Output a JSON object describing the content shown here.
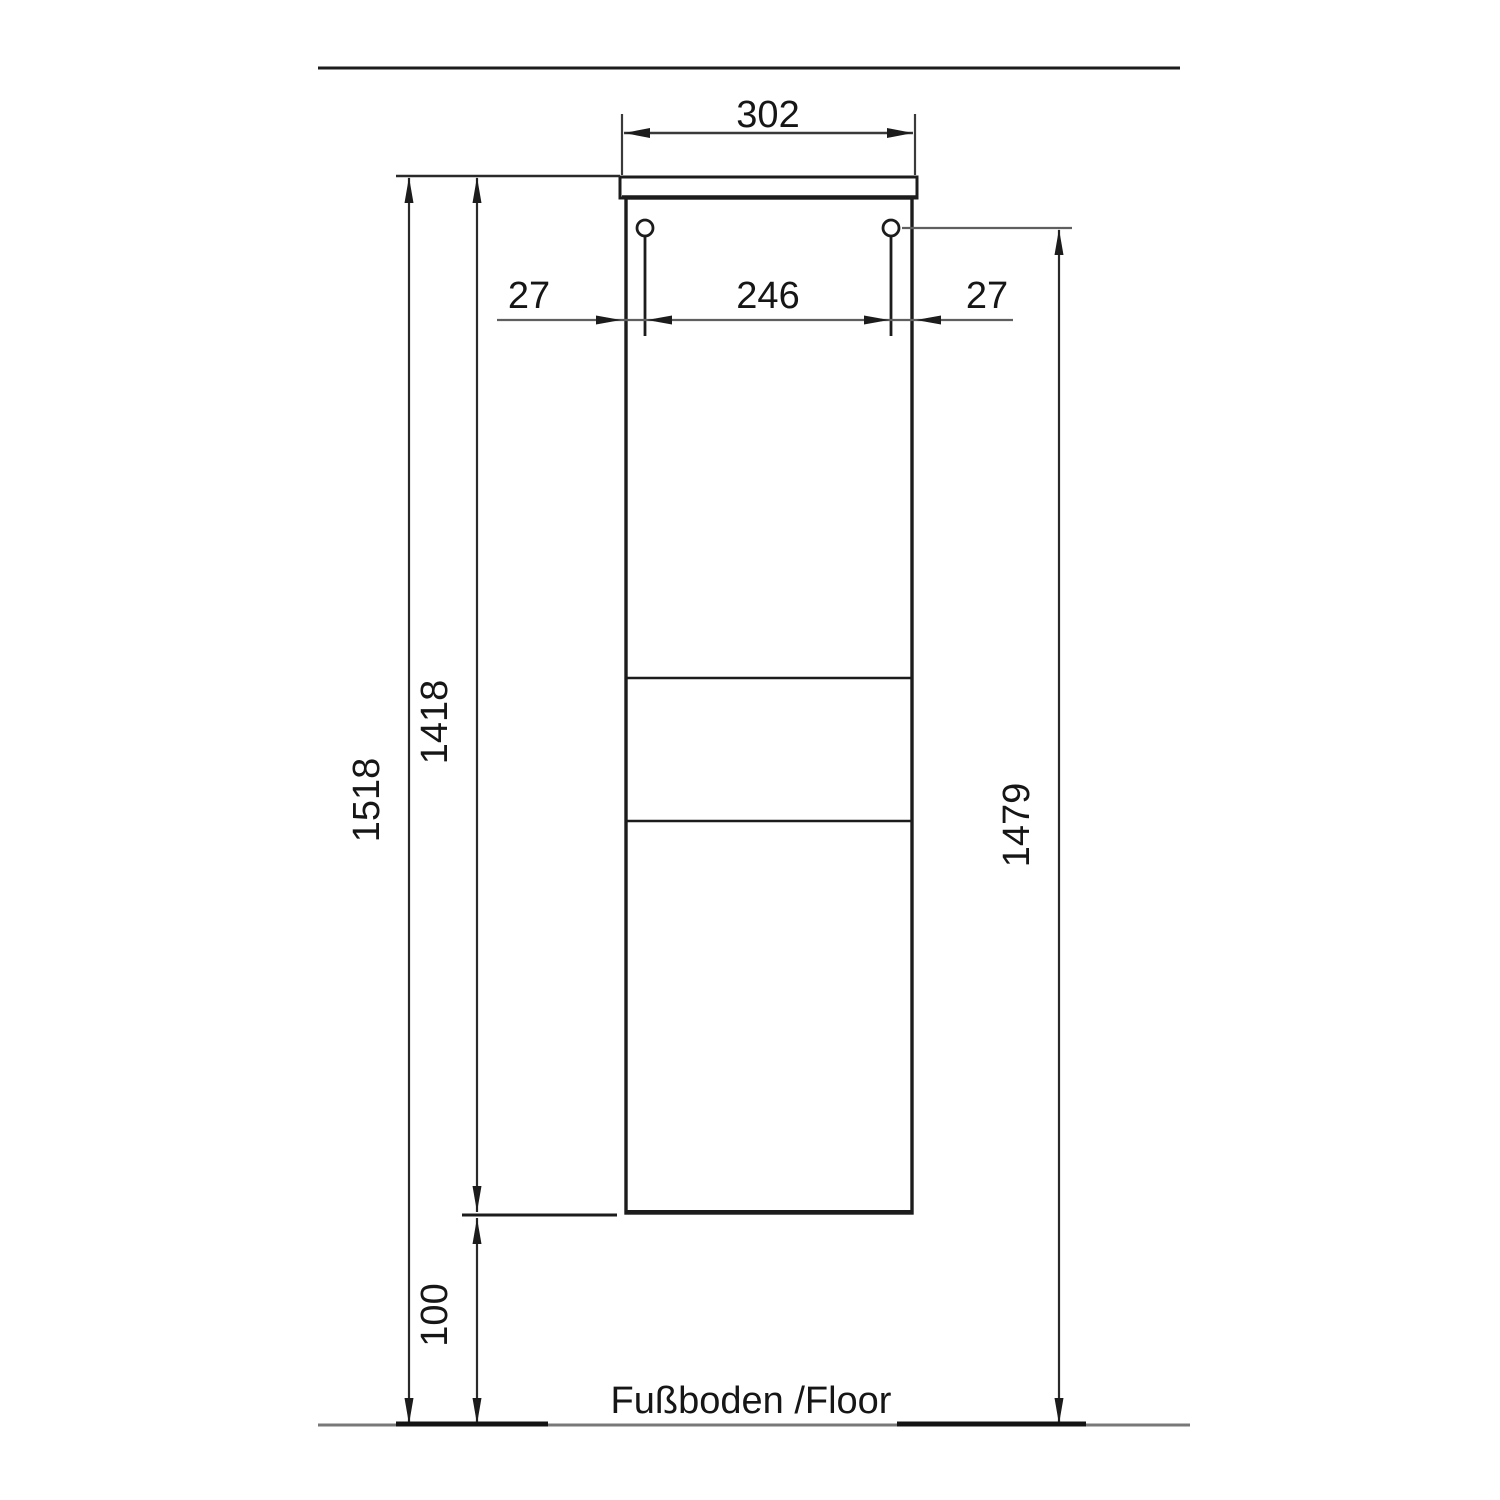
{
  "floor_label": "Fußboden /Floor",
  "dimensions": {
    "top_width": "302",
    "left_hole_offset": "27",
    "hole_spacing": "246",
    "right_hole_offset": "27",
    "total_height": "1518",
    "carcass_height": "1418",
    "hanger_height": "1479",
    "floor_clearance": "100"
  },
  "colors": {
    "object_line": "#1c1c1c",
    "dim_line": "#4a4a4a",
    "thin_dim_line": "#5f5f5f",
    "floor_line": "#787878",
    "text": "#161616"
  }
}
